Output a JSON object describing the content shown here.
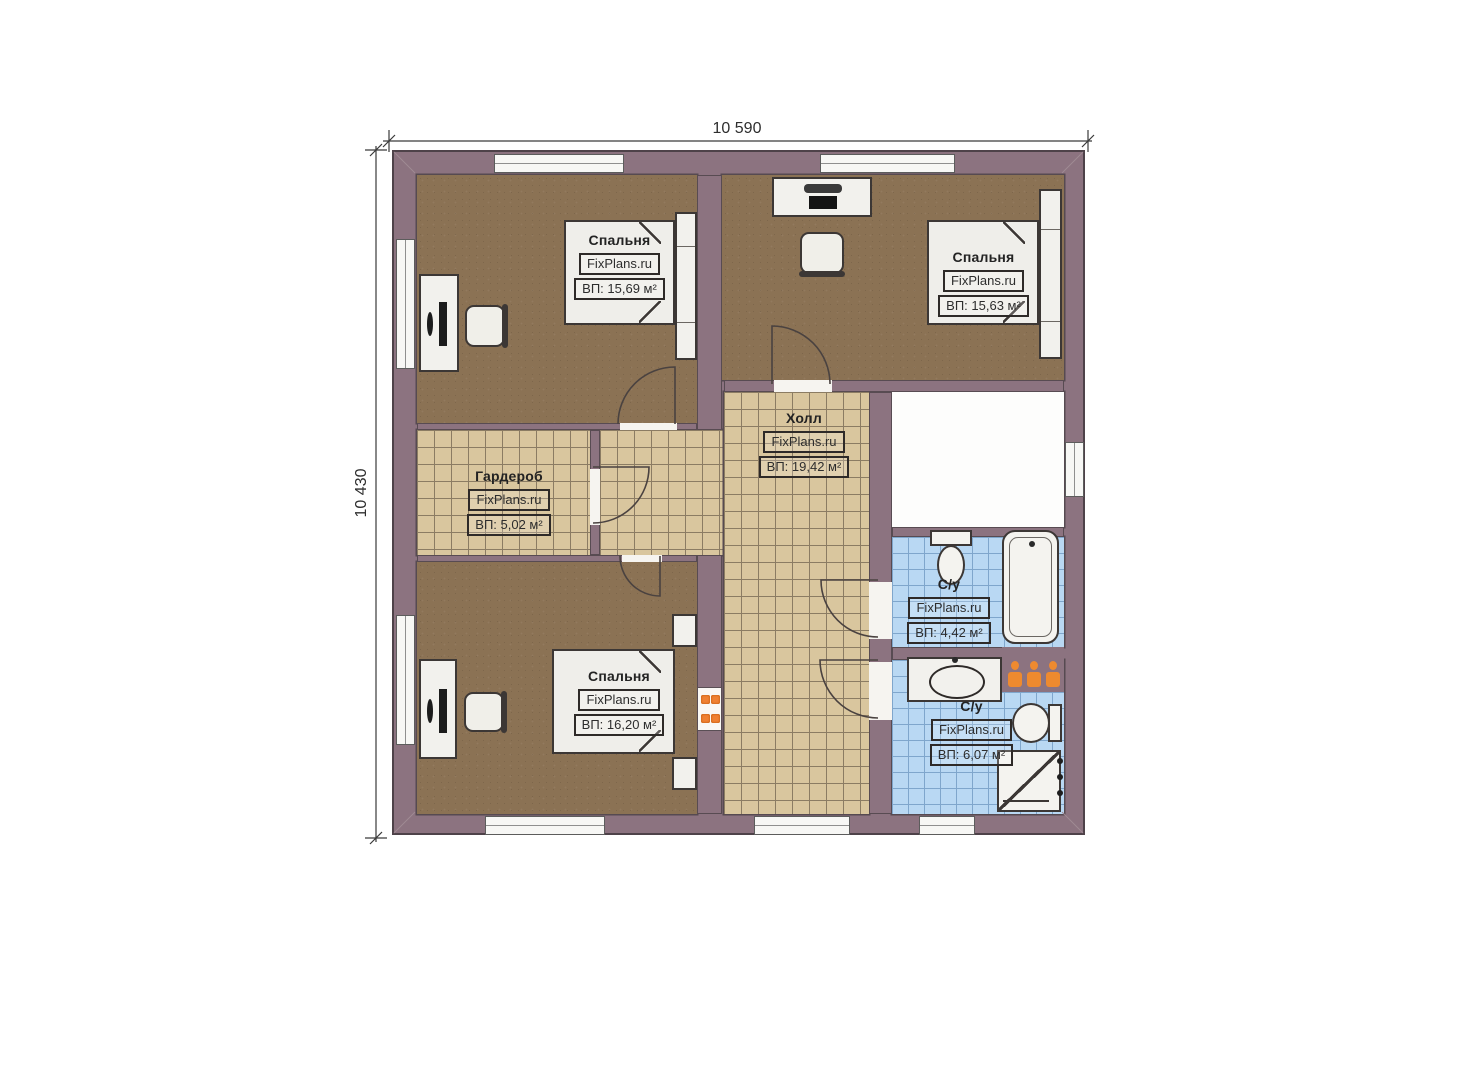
{
  "plan_title": "floor-plan",
  "dimensions": {
    "top": "10 590",
    "left": "10 430"
  },
  "watermark": "FixPlans.ru",
  "rooms": [
    {
      "key": "bedroom-top-left",
      "name": "Спальня",
      "area": "ВП: 15,69 м²"
    },
    {
      "key": "bedroom-top-right",
      "name": "Спальня",
      "area": "ВП: 15,63 м²"
    },
    {
      "key": "hall",
      "name": "Холл",
      "area": "ВП: 19,42 м²"
    },
    {
      "key": "wardrobe",
      "name": "Гардероб",
      "area": "ВП: 5,02 м²"
    },
    {
      "key": "bedroom-bottom-left",
      "name": "Спальня",
      "area": "ВП: 16,20 м²"
    },
    {
      "key": "bathroom-top",
      "name": "С/у",
      "area": "ВП: 4,42 м²"
    },
    {
      "key": "bathroom-bottom",
      "name": "С/у",
      "area": "ВП: 6,07 м²"
    }
  ],
  "colors": {
    "wall": "#8c7380",
    "carpet": "#8b7254",
    "tile": "#d9c69e",
    "wet_tile": "#b9d8f3",
    "accent_orange": "#ee8a2f",
    "furniture_outline": "#3c3735"
  }
}
